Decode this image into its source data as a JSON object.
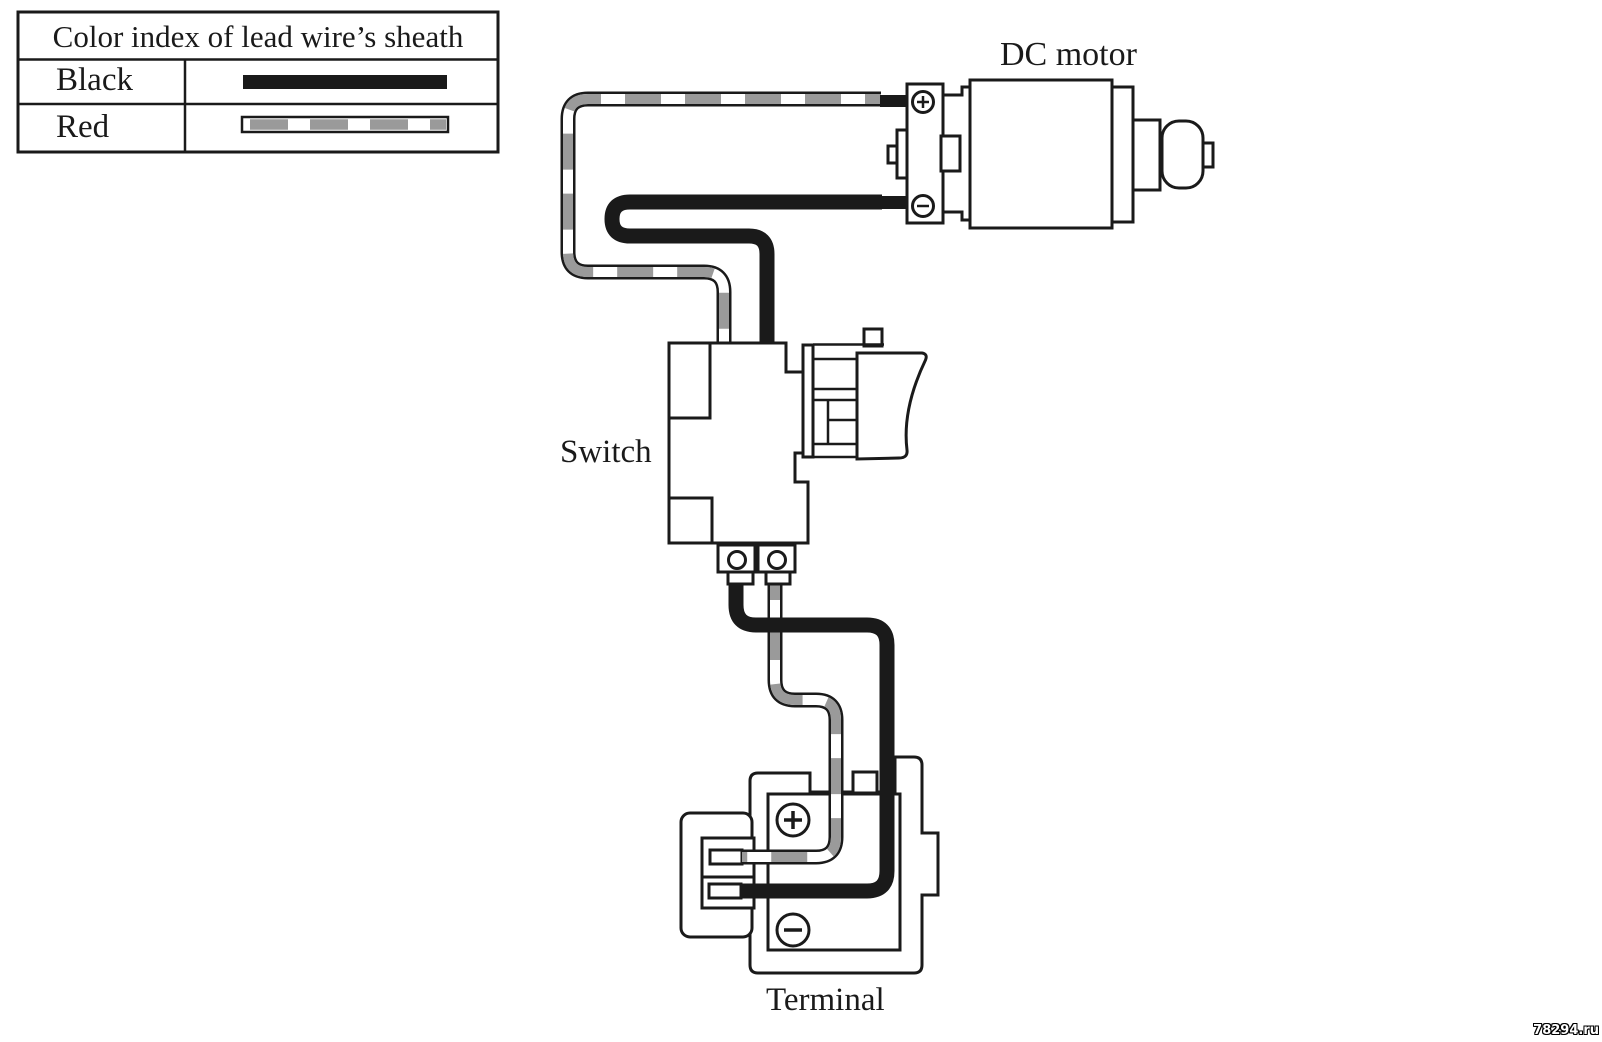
{
  "legend": {
    "title": "Color index of lead wire’s sheath",
    "rows": [
      {
        "color_name": "Black",
        "swatch_style": "solid-black-bar"
      },
      {
        "color_name": "Red",
        "swatch_style": "gray-and-white-striped-bar"
      }
    ]
  },
  "diagram": {
    "component_labels": {
      "motor": "DC motor",
      "switch": "Switch",
      "terminal": "Terminal"
    },
    "polarity_marks": {
      "motor_plus": "+",
      "motor_minus": "−",
      "terminal_plus": "+",
      "terminal_minus": "−"
    },
    "wires": [
      {
        "name": "red-lead",
        "sheath_color": "Red",
        "rendered_as": "white wire with gray stripe segments and black outline",
        "connects": "DC motor (+) terminal — upper path — switch right tab — terminal block upper contact slot"
      },
      {
        "name": "black-lead",
        "sheath_color": "Black",
        "rendered_as": "solid black wire",
        "connects": "DC motor (−) terminal — upper path — switch left tab — terminal block lower contact slot"
      }
    ]
  },
  "watermark": {
    "text": "78294.ru"
  },
  "colors": {
    "ink": "#1a1a1a",
    "paper": "#ffffff",
    "stripe_gray": "#9a9a9a"
  }
}
